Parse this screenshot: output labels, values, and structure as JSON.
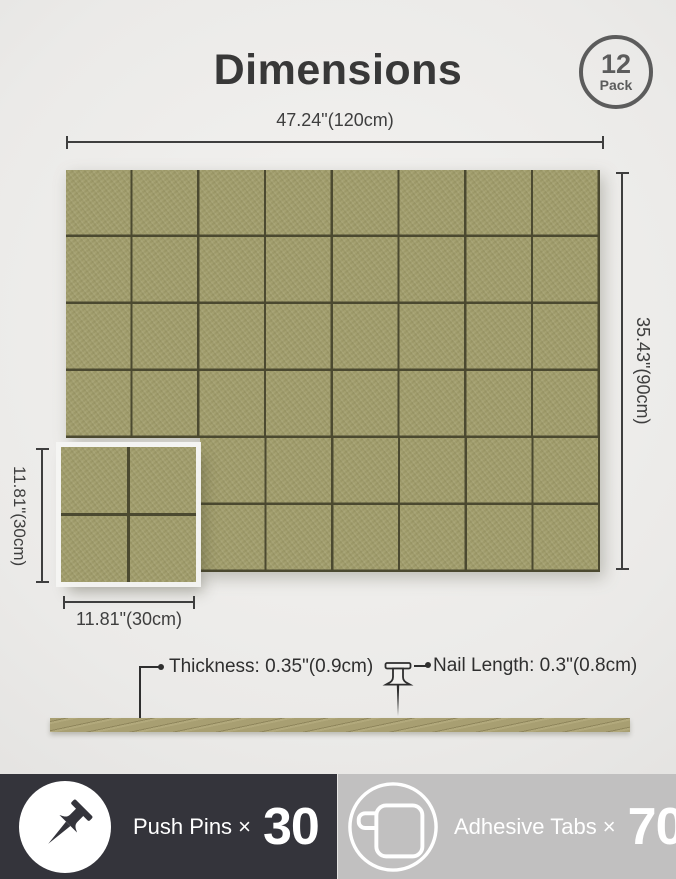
{
  "header": {
    "title": "Dimensions",
    "badge_number": "12",
    "badge_text": "Pack"
  },
  "board": {
    "width_label": "47.24\"(120cm)",
    "height_label": "35.43\"(90cm)",
    "grid_cols": 8,
    "grid_rows": 6
  },
  "tile": {
    "height_label": "11.81\"(30cm)",
    "width_label": "11.81\"(30cm)"
  },
  "side_view": {
    "thickness_label": "Thickness: 0.35\"(0.9cm)",
    "nail_label": "Nail Length: 0.3\"(0.8cm)"
  },
  "footer": {
    "push_pins_label": "Push Pins ×",
    "push_pins_count": "30",
    "adhesive_tabs_label": "Adhesive Tabs ×",
    "adhesive_tabs_count": "70"
  },
  "colors": {
    "felt": "#a19d6b",
    "grid_line": "#4b4930",
    "dimension": "#3e3e3e",
    "strip": "#a89f72",
    "strip_dark": "#8f865c",
    "footer_left_bg": "#34343b",
    "footer_right_bg": "#c1c0c0",
    "badge": "#5c5c5c",
    "text_dark": "#383838"
  }
}
